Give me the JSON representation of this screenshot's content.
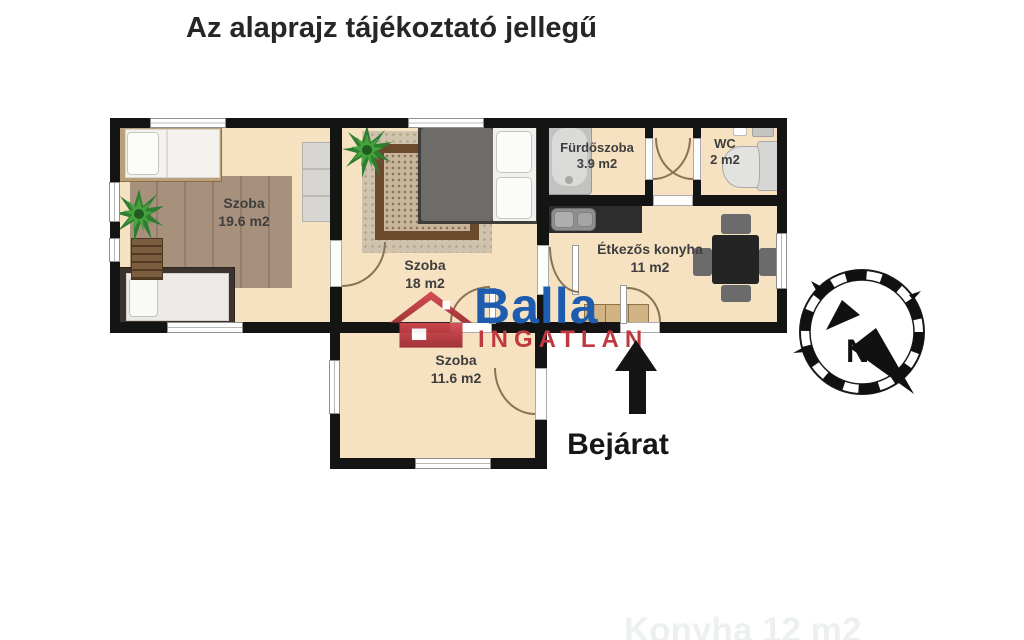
{
  "title": "Az alaprajz tájékoztató jellegű",
  "plan": {
    "rooms": [
      {
        "id": "szoba-19-6",
        "name": "Szoba",
        "area": "19.6 m2"
      },
      {
        "id": "szoba-18",
        "name": "Szoba",
        "area": "18 m2"
      },
      {
        "id": "szoba-11-6",
        "name": "Szoba",
        "area": "11.6 m2"
      },
      {
        "id": "furdoszoba",
        "name": "Fürdőszoba",
        "area": "3.9 m2"
      },
      {
        "id": "wc",
        "name": "WC",
        "area": "2 m2"
      },
      {
        "id": "etkezos-konyha",
        "name": "Étkezős konyha",
        "area": "11 m2"
      }
    ]
  },
  "entrance": {
    "label": "Bejárat"
  },
  "compass": {
    "north_label": "N"
  },
  "watermark": {
    "brand": "Balla",
    "subtitle": "INGATLAN"
  },
  "faint_caption": "Konyha 12 m2",
  "colors": {
    "floor": "#f6e2c1",
    "wall": "#141414",
    "brand_blue": "#1d5caf",
    "brand_red": "#bf3a40",
    "door_arc": "#8a7355",
    "rug_left_room": "#a7917d",
    "rug_middle_room_border": "#6b4a2c"
  }
}
